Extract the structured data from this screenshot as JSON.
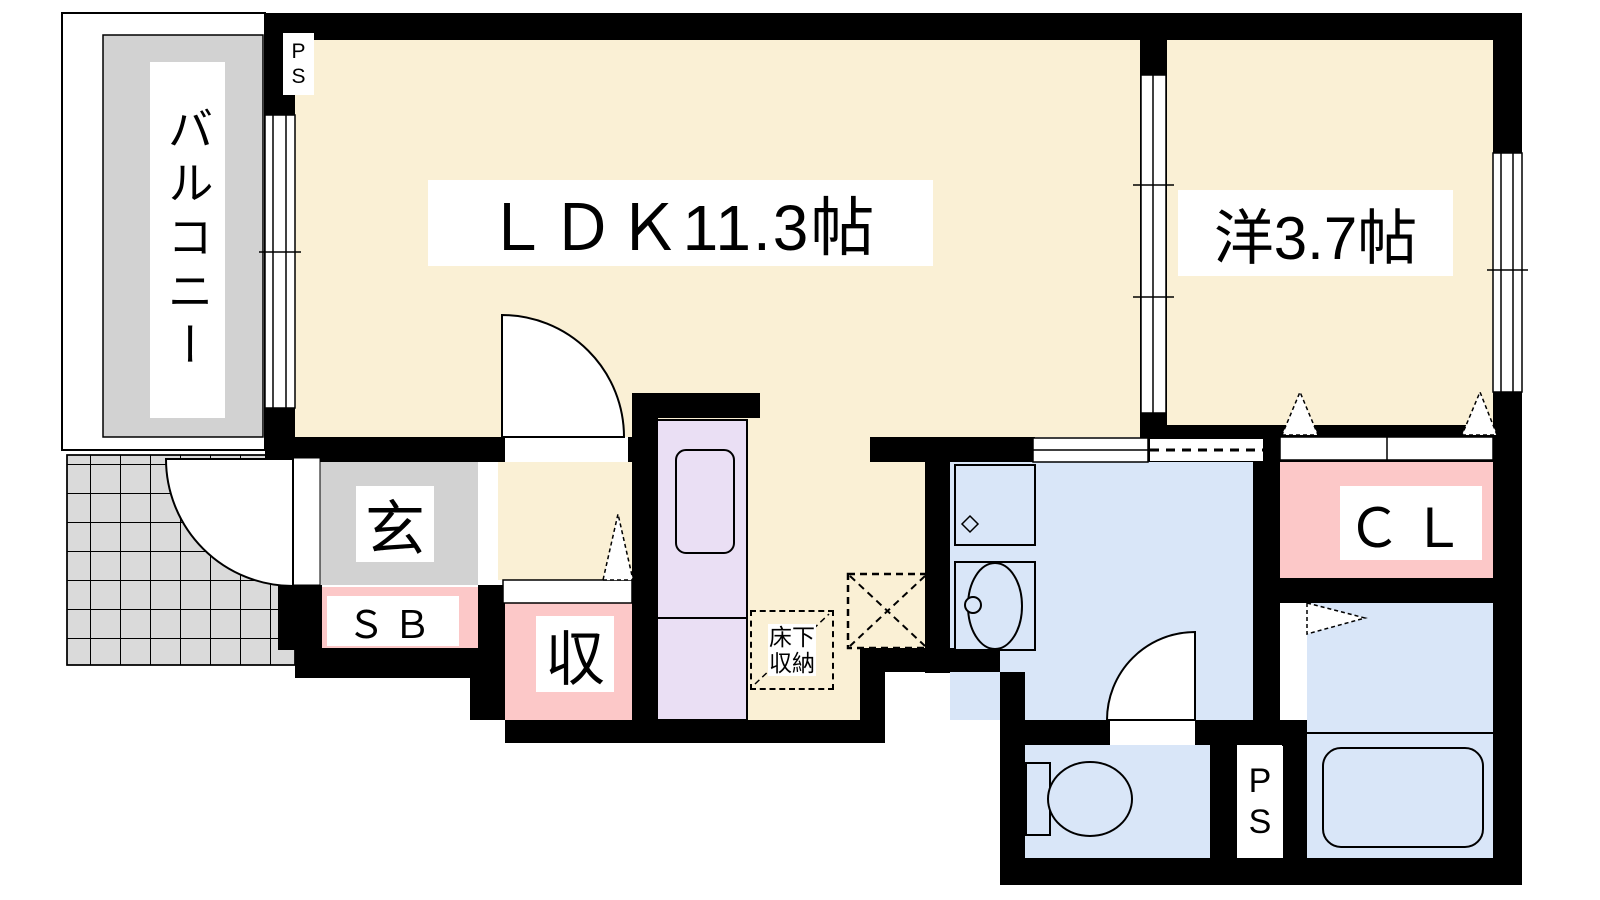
{
  "meta": {
    "type": "japanese-apartment-floor-plan"
  },
  "colors": {
    "wall": "#000000",
    "room": "#FAF0D5",
    "wet": "#D9E6F8",
    "closet": "#FCC8C8",
    "kitchen": "#EADFF4",
    "balcony": "#D2D2D2",
    "porch": "#DADADA"
  },
  "rooms": {
    "balcony": {
      "label": "バルコニー"
    },
    "ldk": {
      "label": "ＬＤＫ11.3帖"
    },
    "western": {
      "label": "洋3.7帖"
    },
    "entrance": {
      "label": "玄"
    },
    "shoe_box": {
      "label": "ＳＢ"
    },
    "storage": {
      "label": "収"
    },
    "closet": {
      "label": "ＣＬ"
    },
    "underfloor": {
      "line1": "床下",
      "line2": "収納"
    },
    "ps_top": {
      "line1": "P",
      "line2": "S"
    },
    "ps_bottom": {
      "line1": "P",
      "line2": "S"
    }
  }
}
